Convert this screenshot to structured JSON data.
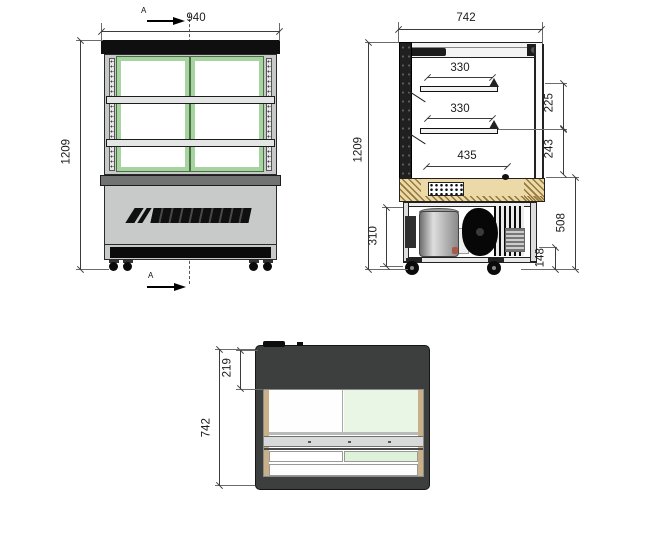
{
  "views": {
    "front": {
      "label_width": "940",
      "label_height": "1209",
      "section_marker": "A"
    },
    "side": {
      "label_depth": "742",
      "label_height": "1209",
      "label_shelf_top": "330",
      "label_shelf_mid": "330",
      "label_deck": "435",
      "label_gap_upper": "225",
      "label_gap_lower": "243",
      "label_machine": "310",
      "label_base": "508",
      "label_clearance": "148"
    },
    "top": {
      "label_depth": "742",
      "label_inset": "219"
    }
  },
  "colors": {
    "frame_green": "#a6d39f",
    "pane_white": "#ffffff",
    "deck_tan": "#ecd9a8",
    "body_dark": "#3d3f3e",
    "panel_gray": "#c7cac9",
    "band_black": "#0f0f0f",
    "glass_green_tint": "#e9f5e5"
  }
}
